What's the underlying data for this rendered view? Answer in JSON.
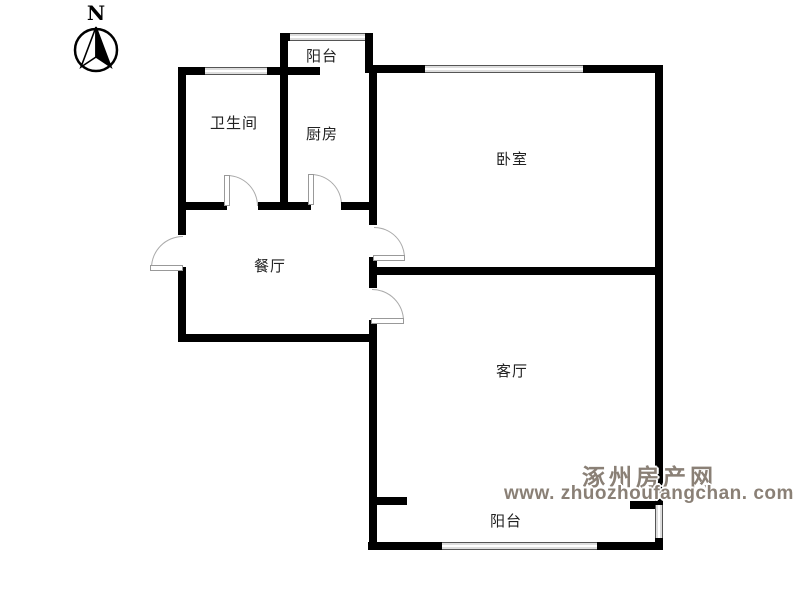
{
  "title": "apartment-floor-plan",
  "compass": {
    "label": "N"
  },
  "rooms": [
    {
      "id": "balcony-top",
      "label": "阳台"
    },
    {
      "id": "bathroom",
      "label": "卫生间"
    },
    {
      "id": "kitchen",
      "label": "厨房"
    },
    {
      "id": "bedroom",
      "label": "卧室"
    },
    {
      "id": "dining-room",
      "label": "餐厅"
    },
    {
      "id": "living-room",
      "label": "客厅"
    },
    {
      "id": "balcony-bottom",
      "label": "阳台"
    }
  ],
  "watermark": {
    "site_name": "涿州房产网",
    "site_url": "www. zhuozhoufangchan. com",
    "color": "#8a8076"
  },
  "colors": {
    "background": "#ffffff",
    "wall": "#000000",
    "door_arc": "#aaaaaa",
    "window_line": "#555555",
    "label_text": "#222222"
  }
}
